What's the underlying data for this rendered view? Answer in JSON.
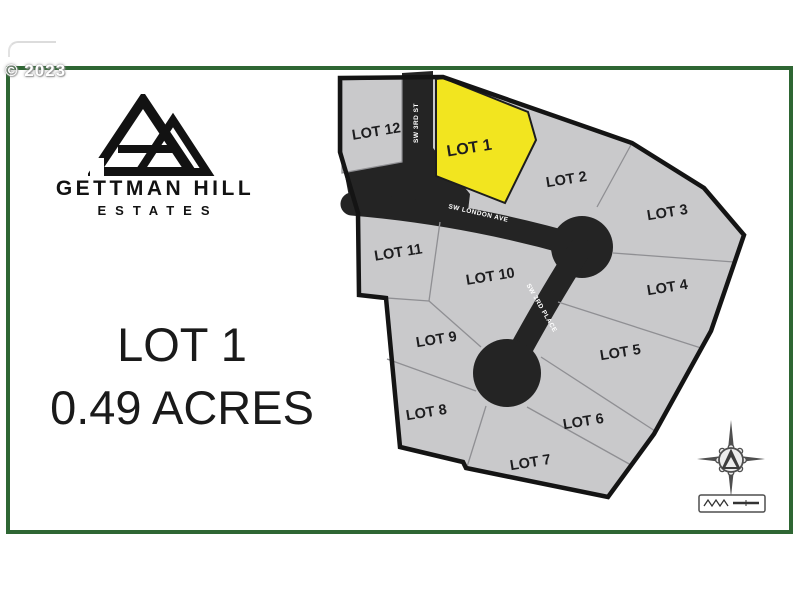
{
  "watermark": "© 2023",
  "branding": {
    "name": "GETTMAN HILL",
    "subtitle": "ESTATES"
  },
  "listing": {
    "lot_label": "LOT 1",
    "acreage_label": "0.49 ACRES"
  },
  "map": {
    "highlighted_lot": "LOT 1",
    "lots": [
      {
        "label": "LOT 1"
      },
      {
        "label": "LOT 2"
      },
      {
        "label": "LOT 3"
      },
      {
        "label": "LOT 4"
      },
      {
        "label": "LOT 5"
      },
      {
        "label": "LOT 6"
      },
      {
        "label": "LOT 7"
      },
      {
        "label": "LOT 8"
      },
      {
        "label": "LOT 9"
      },
      {
        "label": "LOT 10"
      },
      {
        "label": "LOT 11"
      },
      {
        "label": "LOT 12"
      }
    ],
    "streets": [
      {
        "name": "SW 3RD ST"
      },
      {
        "name": "SW LONDON AVE"
      },
      {
        "name": "SW 3RD PLACE"
      }
    ]
  },
  "colors": {
    "frame_green": "#2e6633",
    "highlight_yellow": "#f2e51f",
    "lot_gray": "#c9c9cb",
    "street_dark": "#242424",
    "boundary_black": "#141414"
  }
}
